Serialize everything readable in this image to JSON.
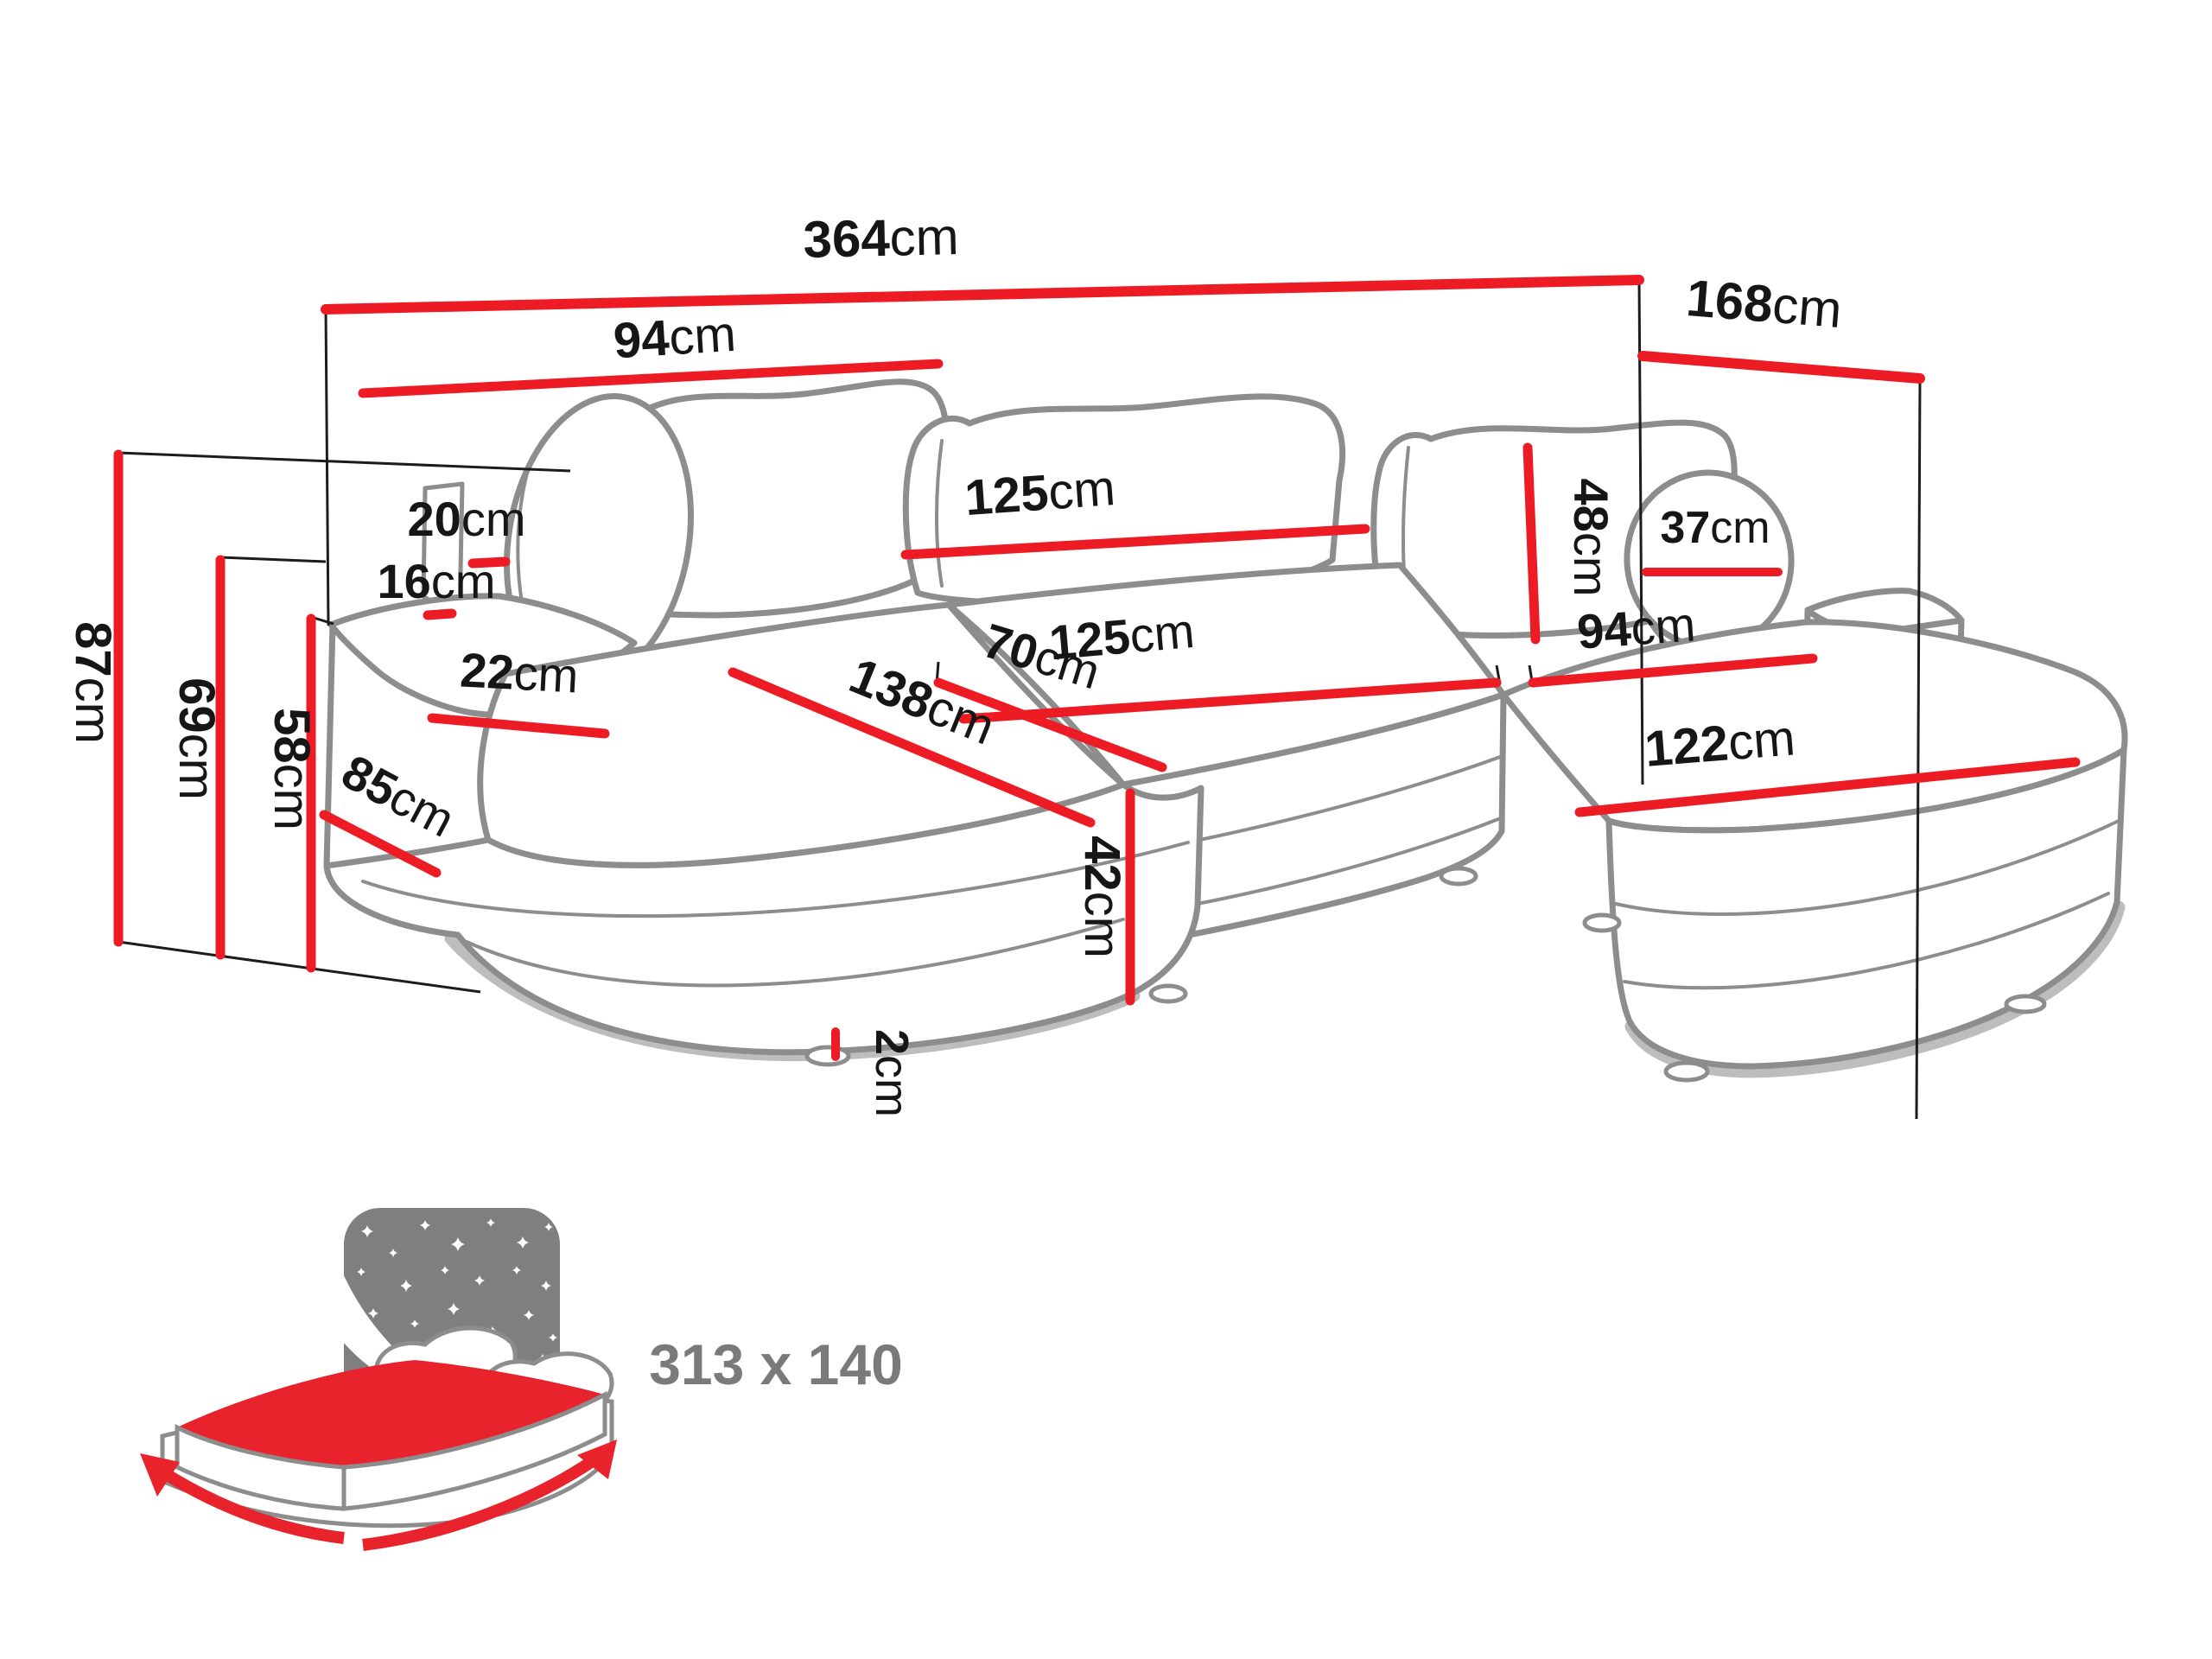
{
  "diagram": {
    "type": "sofa-dimension-diagram",
    "unit": "cm",
    "labels": {
      "total_width": {
        "value": "364",
        "unit": "cm"
      },
      "total_depth": {
        "value": "168",
        "unit": "cm"
      },
      "left_back_cushion": {
        "value": "94",
        "unit": "cm"
      },
      "middle_back_cushion": {
        "value": "125",
        "unit": "cm"
      },
      "right_back_cushion_h": {
        "value": "48",
        "unit": "cm"
      },
      "round_pillow": {
        "value": "37",
        "unit": "cm"
      },
      "backrest_thickness": {
        "value": "20",
        "unit": "cm"
      },
      "gap_behind_armrest": {
        "value": "16",
        "unit": "cm"
      },
      "armrest_width": {
        "value": "22",
        "unit": "cm"
      },
      "total_height": {
        "value": "87",
        "unit": "cm"
      },
      "backrest_height": {
        "value": "69",
        "unit": "cm"
      },
      "armrest_height": {
        "value": "58",
        "unit": "cm"
      },
      "left_side_depth": {
        "value": "85",
        "unit": "cm"
      },
      "left_chaise_length": {
        "value": "138",
        "unit": "cm"
      },
      "seat_depth": {
        "value": "70",
        "unit": "cm"
      },
      "middle_seat_width": {
        "value": "125",
        "unit": "cm"
      },
      "right_seat_width": {
        "value": "94",
        "unit": "cm"
      },
      "right_chaise_length": {
        "value": "122",
        "unit": "cm"
      },
      "seat_height": {
        "value": "42",
        "unit": "cm"
      },
      "leg_height": {
        "value": "2",
        "unit": "cm"
      }
    },
    "sleeping_area": {
      "value": "313 x 140"
    }
  },
  "colors": {
    "measure_red": "#ED1C24",
    "icon_red": "#E8232B",
    "sofa_outline": "#8D8D8D",
    "guide_black": "#1C1C1C",
    "icon_gray": "#7F7F7F",
    "label_text": "#161616"
  }
}
